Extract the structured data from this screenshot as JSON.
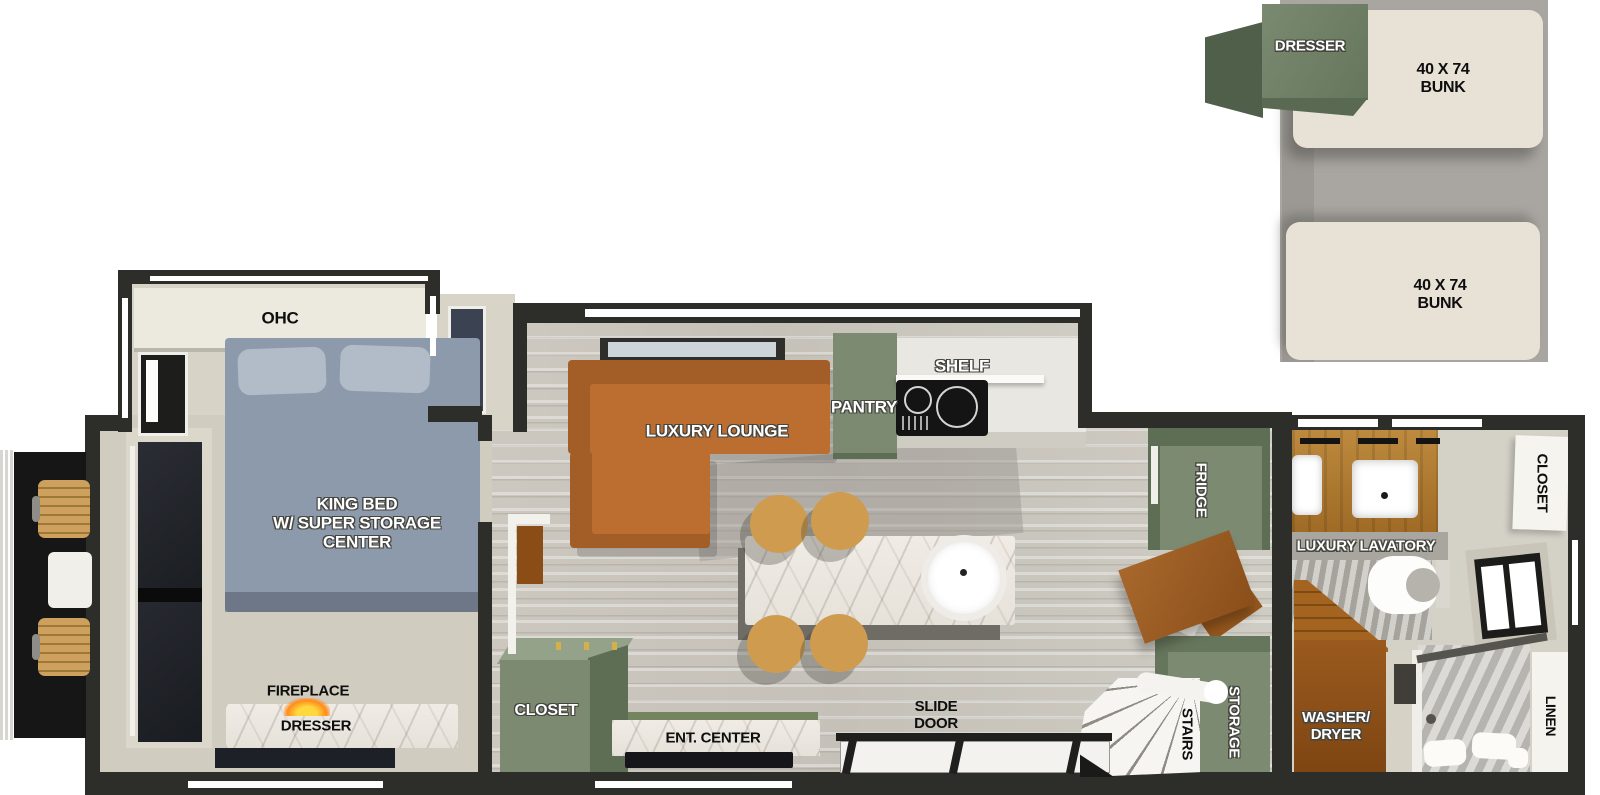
{
  "title": "RV floorplan with rear loft bunks",
  "colors": {
    "wall_black": "#2d2d29",
    "cabinet_green": "#7b8a70",
    "cabinet_green_dark": "#5e6e55",
    "sofa_orange": "#b5662a",
    "bed_blue": "#8d9aac",
    "wood_brown": "#9e6a25",
    "bunk_beige": "#e8e1d6",
    "loft_gray": "#a9a6a1",
    "floor_beige": "#d2cec2",
    "stool_tan": "#cf9c4f",
    "flame_orange": "#ff8c1a"
  },
  "loft": {
    "dresser": "DRESSER",
    "bunk_top": "40 X 74\nBUNK",
    "bunk_bottom": "40 X 74\nBUNK"
  },
  "bedroom": {
    "ohc": "OHC",
    "king_bed": "KING BED\nW/ SUPER STORAGE\nCENTER",
    "fireplace": "FIREPLACE",
    "dresser": "DRESSER"
  },
  "living": {
    "luxury_lounge": "LUXURY LOUNGE",
    "pantry": "PANTRY",
    "shelf": "SHELF",
    "closet": "CLOSET",
    "ent_center": "ENT. CENTER",
    "slide_door": "SLIDE\nDOOR",
    "fridge": "FRIDGE",
    "storage": "STORAGE",
    "stairs": "STAIRS"
  },
  "bath": {
    "luxury_lavatory": "LUXURY LAVATORY",
    "closet": "CLOSET",
    "washer_dryer": "WASHER/\nDRYER",
    "linen": "LINEN"
  }
}
